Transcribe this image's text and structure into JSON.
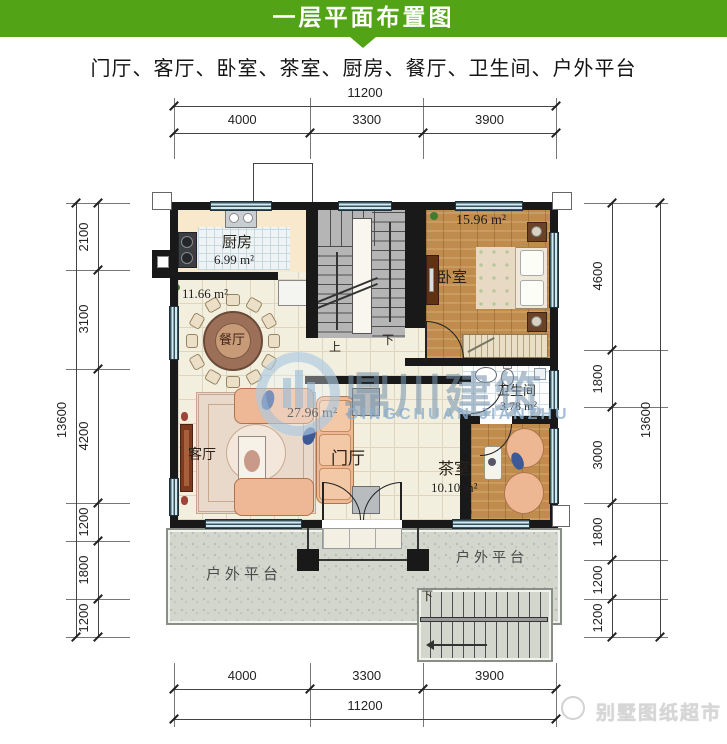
{
  "header": {
    "title": "一层平面布置图"
  },
  "subtitle": "门厅、客厅、卧室、茶室、厨房、餐厅、卫生间、户外平台",
  "rooms": {
    "kitchen": {
      "name": "厨房",
      "area": "6.99 m²"
    },
    "dining": {
      "name": "餐厅",
      "area": "11.66 m²"
    },
    "bedroom": {
      "name": "卧室",
      "area": "15.96 m²"
    },
    "bathroom": {
      "name": "卫生间",
      "area": "3.78 m²"
    },
    "tearoom": {
      "name": "茶室",
      "area": "10.10 m²"
    },
    "foyer": {
      "name": "门厅",
      "area": "27.96 m²"
    },
    "living": {
      "name": "客厅"
    },
    "platform_left": {
      "name": "户外平台"
    },
    "platform_right": {
      "name": "户外平台"
    }
  },
  "stairs": {
    "up_label": "上",
    "down_label": "下",
    "outdoor_down_label": "下"
  },
  "dimensions": {
    "top": {
      "overall": "11200",
      "segments": [
        "4000",
        "3300",
        "3900"
      ]
    },
    "bottom": {
      "overall": "11200",
      "segments": [
        "4000",
        "3300",
        "3900"
      ]
    },
    "left": {
      "overall": "13600",
      "segments": [
        "2100",
        "3100",
        "4200",
        "1200",
        "1800",
        "1200"
      ]
    },
    "right": {
      "overall": "13600",
      "segments": [
        "4600",
        "1800",
        "3000",
        "1800",
        "1200",
        "1200"
      ]
    }
  },
  "watermark": {
    "cn": "鼎川建筑",
    "en": "DINGCHUAN JIANZHU"
  },
  "footer_watermark": {
    "text": "别墅图纸超市"
  },
  "colors": {
    "banner_green": "#52a315",
    "wall_black": "#191919",
    "wood_floor": "#bf8c4e",
    "tile_cream": "#f3efdf",
    "kitchen_beige": "#f8e8cc",
    "concrete_gray": "#d2d6cc",
    "window_blue": "#d3e9f0",
    "watermark_blue": "#7894ac"
  }
}
